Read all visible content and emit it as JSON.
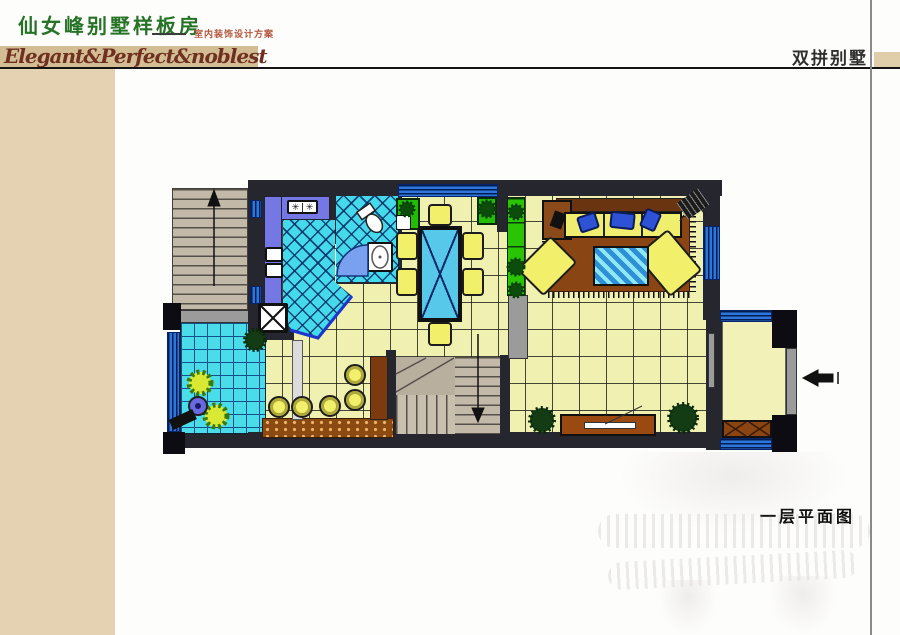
{
  "header": {
    "title": "仙女峰别墅样板房",
    "subtitle": "室内装饰设计方案",
    "tagline": "Elegant&Perfect&noblest",
    "project_type": "双拼别墅"
  },
  "plan": {
    "caption": "一层平面图",
    "stove_burner_icon": "✳",
    "icons": {
      "stairs-up-arrow": "↑",
      "stairs-down-arrow": "↓",
      "entry-arrow": "←"
    }
  },
  "palette": {
    "sidebar_beige": "#e4d2b2",
    "band_tan": "#d3bd95",
    "title_green": "#267326",
    "subtitle_red": "#b2543c",
    "tagline_maroon": "#6f3020",
    "floor_yellow": "#f0f0b0",
    "tile_cyan": "#45d9ec",
    "window_blue": "#2b77dd",
    "counter_purple": "#7577e5",
    "planter_green": "#2bc405",
    "wood_brown": "#8a4a1a",
    "wall_dark": "#26262e"
  }
}
